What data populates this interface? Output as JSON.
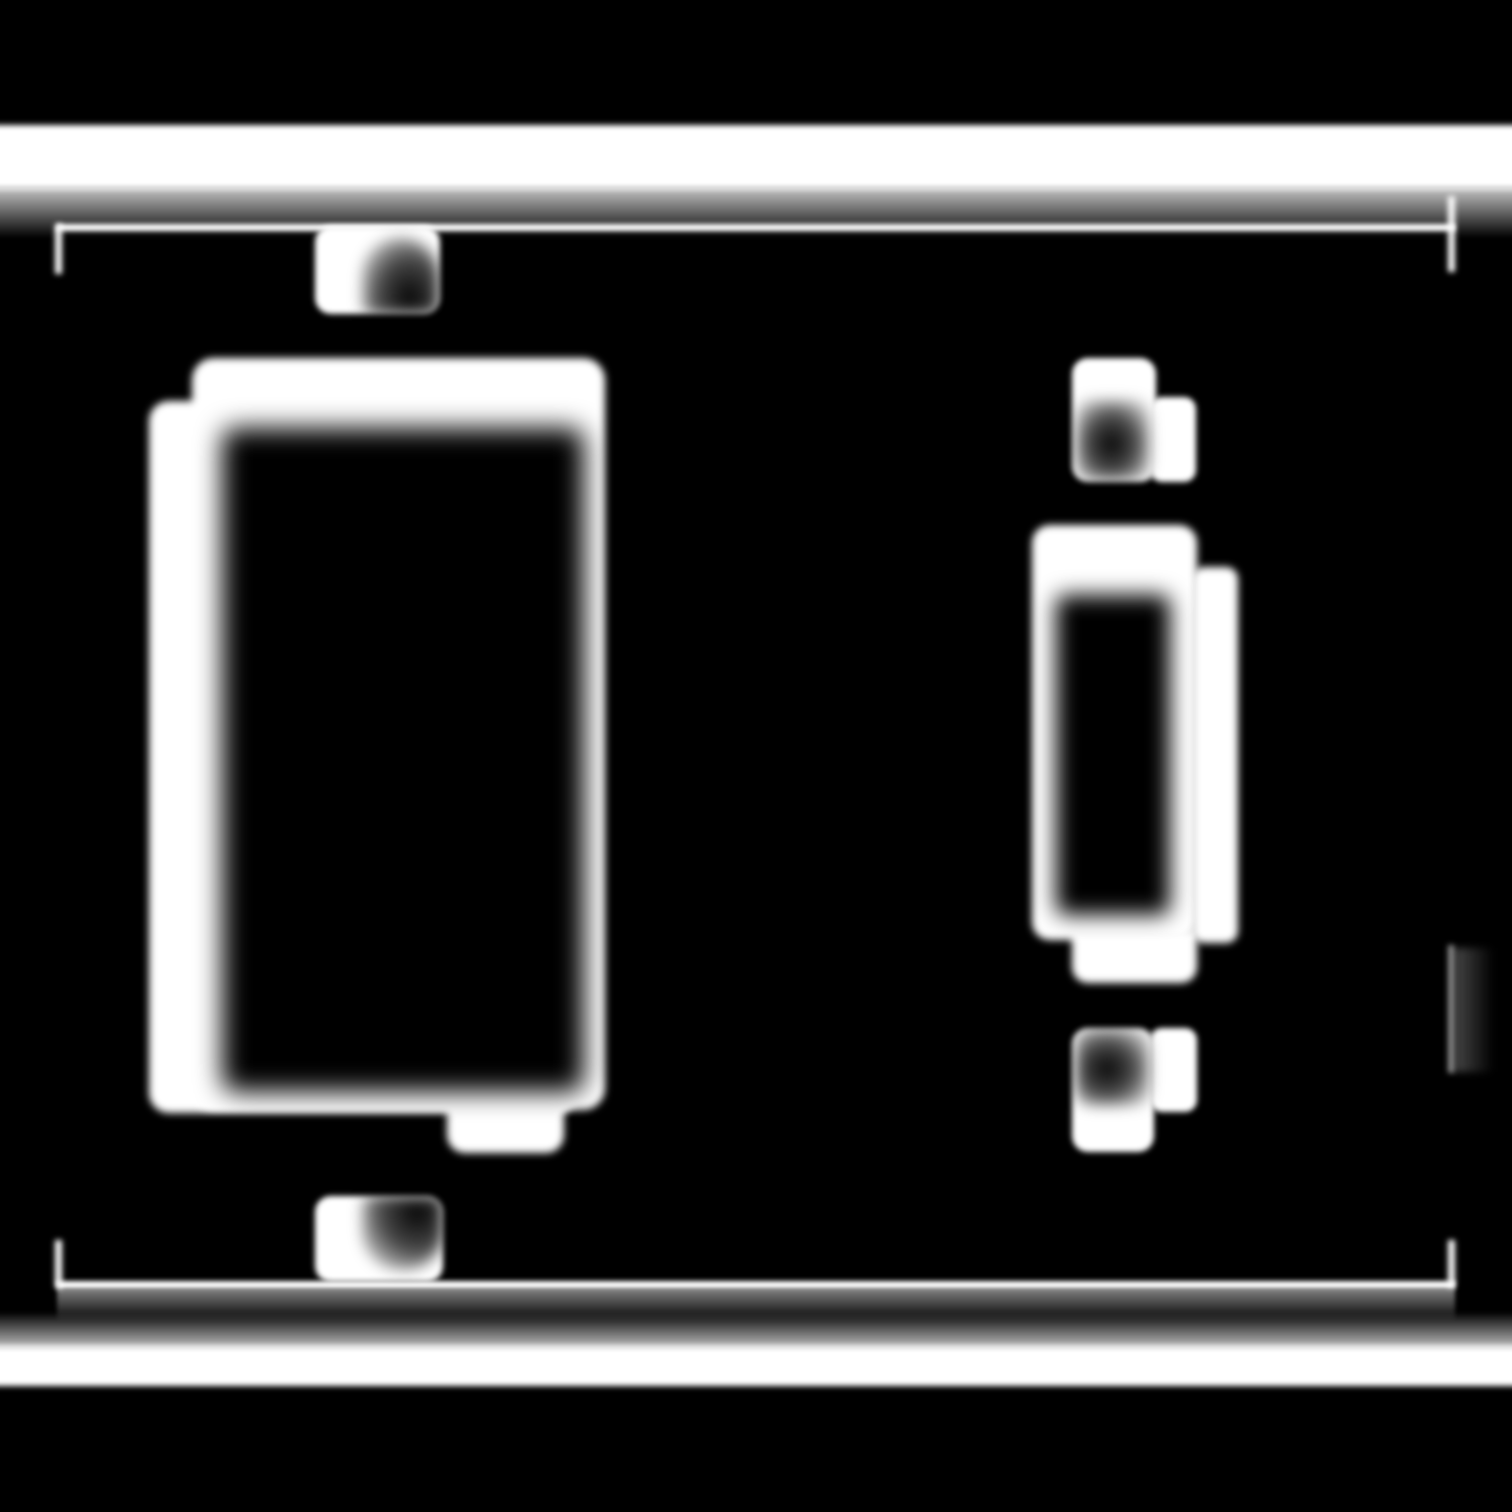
{
  "canvas": {
    "width": 1512,
    "height": 1512
  },
  "colors": {
    "background": "#000000",
    "foreground": "#ffffff"
  },
  "diagram": {
    "kind": "blurred white-on-black line drawing of a two-gang wall switch plate",
    "components": [
      {
        "name": "plate-top-edge-highlight",
        "shape": "full-width horizontal white band near top"
      },
      {
        "name": "plate-bottom-edge-highlight",
        "shape": "full-width horizontal white band near bottom"
      },
      {
        "name": "bezel-outline",
        "shape": "thin inset rectangle line with short corner ticks and faint right-side segment"
      },
      {
        "name": "rocker-module",
        "shape": "large rounded rectangular frame with black rocker opening, offset under-layer, bottom tab"
      },
      {
        "name": "rocker-opening",
        "shape": "large black rectangle inside left frame"
      },
      {
        "name": "toggle-module",
        "shape": "small rounded rectangular frame with black vertical toggle-lever slot, offset side layer, bottom tab"
      },
      {
        "name": "toggle-lever-slot",
        "shape": "black vertical slot inside right frame"
      },
      {
        "name": "mounting-screw-top-left",
        "shape": "white rounded square with dark arched slot"
      },
      {
        "name": "mounting-screw-bottom-left",
        "shape": "white rounded square with dark round-bottom slot"
      },
      {
        "name": "mounting-screw-top-right",
        "shape": "stepped white rounded square with dark slot"
      },
      {
        "name": "mounting-screw-bottom-right",
        "shape": "stepped white rounded square with dark slot"
      }
    ]
  }
}
